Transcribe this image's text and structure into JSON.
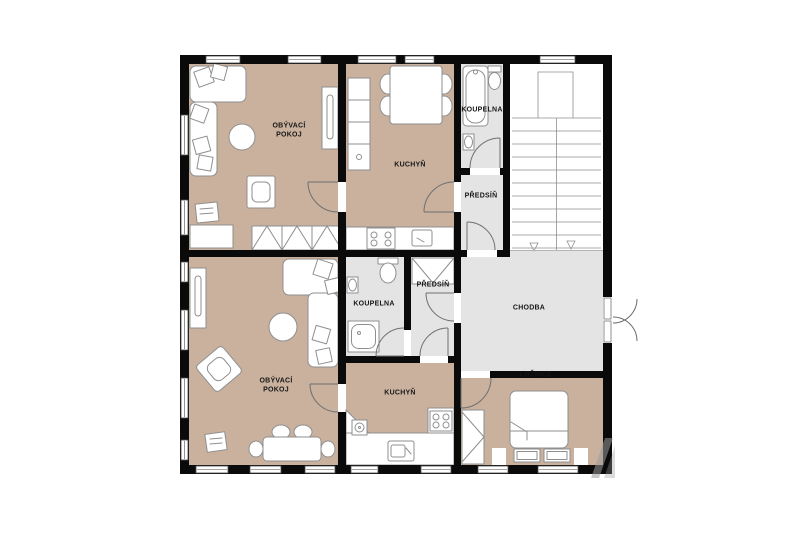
{
  "floorplan": {
    "rooms": [
      {
        "name": "living-room-1",
        "label": "OBÝVACÍ\nPOKOJ"
      },
      {
        "name": "kitchen-1",
        "label": "KUCHYŇ"
      },
      {
        "name": "bathroom-1",
        "label": "KOUPELNA"
      },
      {
        "name": "entry-hall-1",
        "label": "PŘEDSÍŇ"
      },
      {
        "name": "corridor",
        "label": "CHODBA"
      },
      {
        "name": "bathroom-2",
        "label": "KOUPELNA"
      },
      {
        "name": "entry-hall-2",
        "label": "PŘEDSÍŇ"
      },
      {
        "name": "living-room-2",
        "label": "OBÝVACÍ\nPOKOJ"
      },
      {
        "name": "kitchen-2",
        "label": "KUCHYŇ"
      },
      {
        "name": "bedroom",
        "label": "LOŽNICE"
      }
    ],
    "colors": {
      "floor_wood": "#c9b19e",
      "floor_tile": "#e4e4e4",
      "wall": "#0a0a0a",
      "furniture_outline": "#8f8f8f",
      "background": "#ffffff"
    }
  }
}
